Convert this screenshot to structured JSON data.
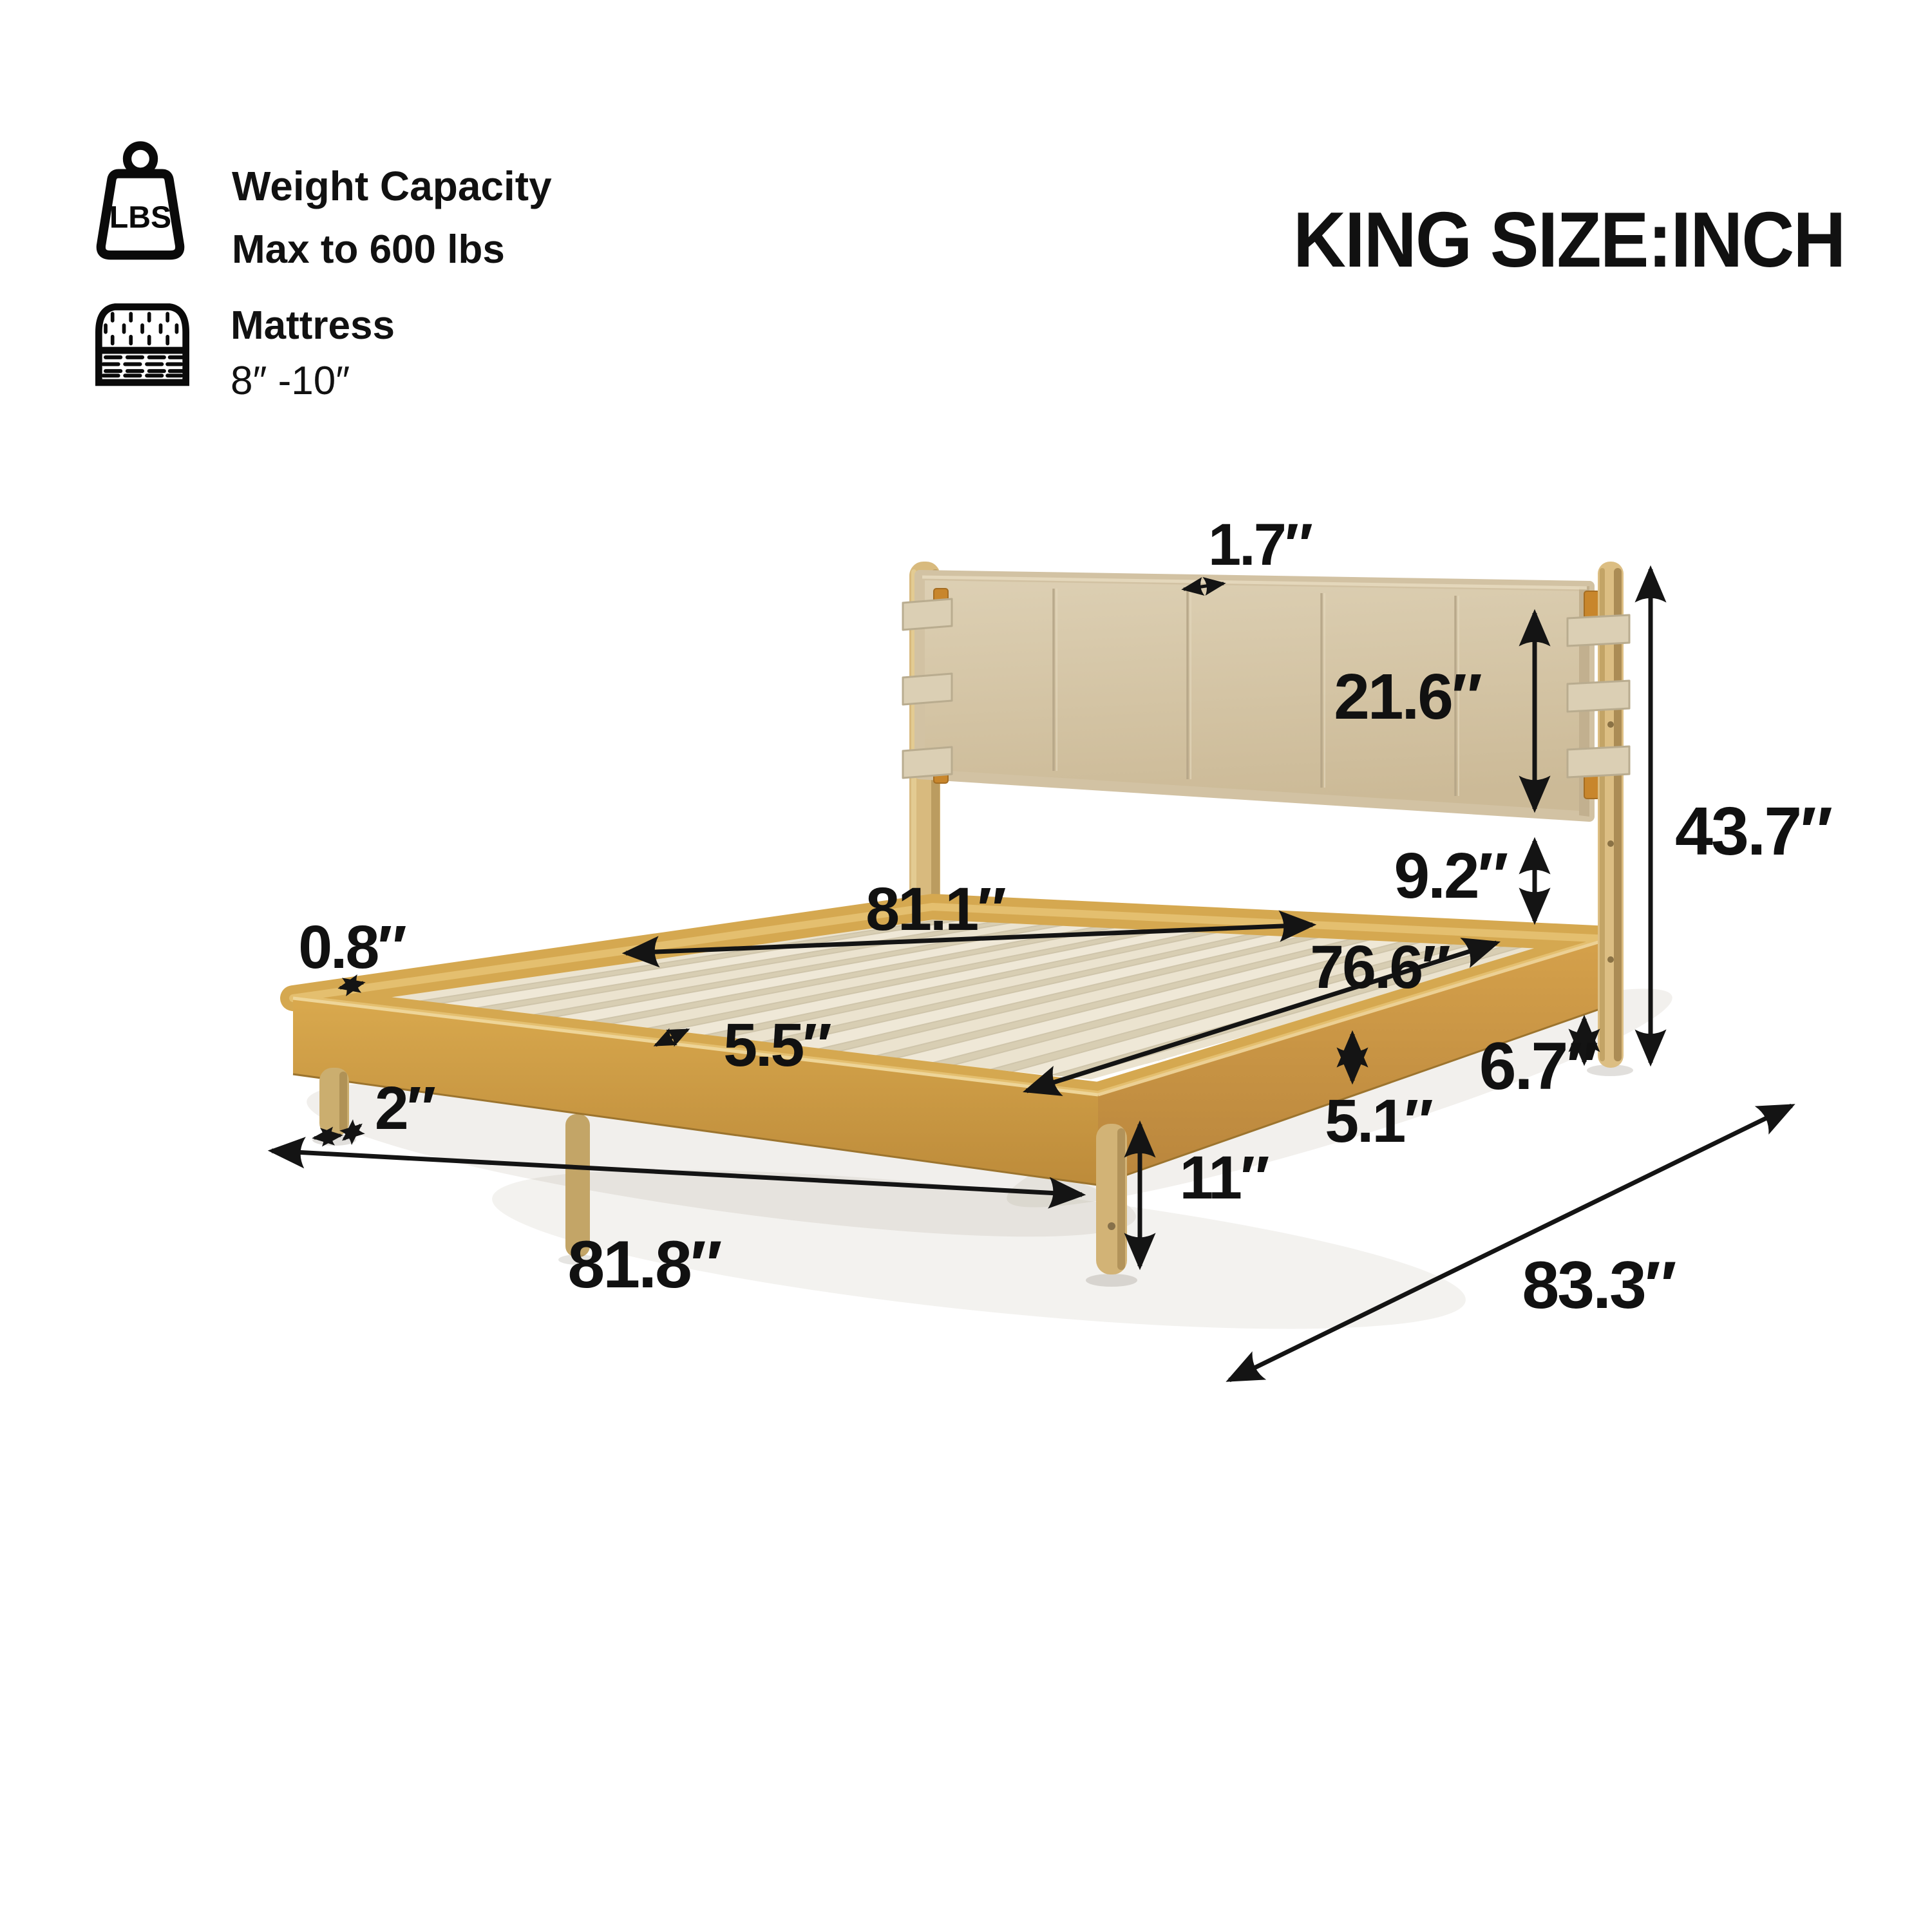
{
  "title": "KING SIZE:INCH",
  "specs": {
    "weight": {
      "icon": "weight-lbs-icon",
      "icon_text": "LBS",
      "label": "Weight Capacity",
      "value": "Max to 600 lbs"
    },
    "mattress": {
      "icon": "mattress-icon",
      "label": "Mattress",
      "value": "8″ -10″"
    }
  },
  "unit": "INCH",
  "dimensions": {
    "headboard_thickness": "1.7″",
    "headboard_panel_height": "21.6″",
    "panel_to_frame_gap": "9.2″",
    "total_height": "43.7″",
    "slat_length": "81.1″",
    "inner_width": "76.6″",
    "rim_thickness": "0.8″",
    "slat_spacing": "5.5″",
    "leg_diameter": "2″",
    "frame_length": "81.8″",
    "leg_height": "11″",
    "rail_height": "5.1″",
    "rail_to_floor": "6.7″",
    "frame_depth": "83.3″"
  }
}
